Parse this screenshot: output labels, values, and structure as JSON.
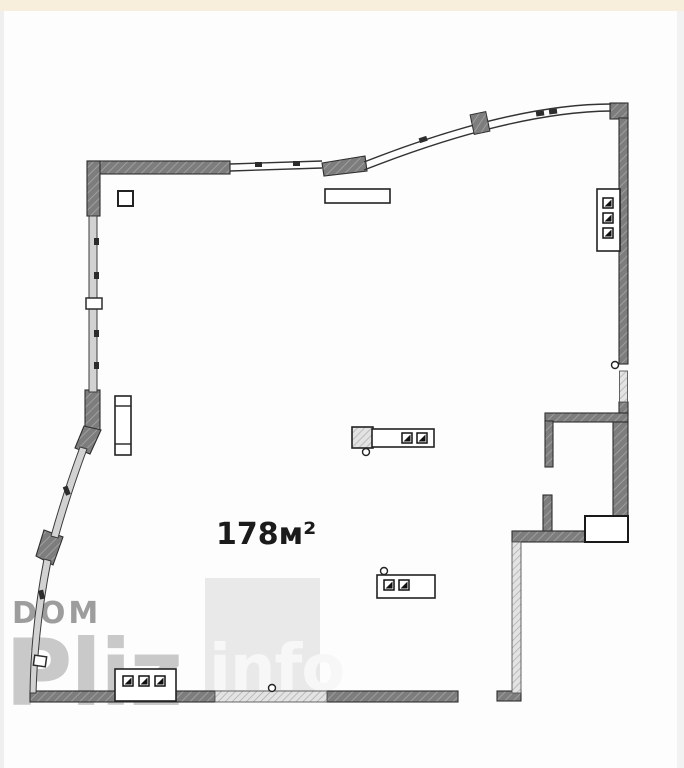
{
  "page": {
    "top_strip_color": "#f8eedc",
    "background_color": "#fdfdfd",
    "edge_border_color": "#efefef"
  },
  "plan": {
    "area_label": "178м²",
    "wall_color": "#7d7d7d",
    "light_wall_color": "#d8d8d8",
    "window_band_color": "#d2d2d2",
    "line_color": "#2e2e2e",
    "icons": {
      "electrical_panel_right": "panel-with-3-switch-squares",
      "electrical_panel_bottom": "panel-with-3-switch-squares",
      "island_unit_center": "hatched-block-with-2-switch-squares",
      "socket_box_lower": "box-with-2-switch-squares",
      "column_left": "tall-rect-with-dividers",
      "door_hinge_circles": "small-circle-markers"
    }
  },
  "watermark": {
    "word1": "DOM",
    "word2": "Pliz",
    "word3": "info",
    "word1_color": "#9d9d9d",
    "word2_color": "#c9c9c9",
    "word3_color": "#f7f7f7",
    "block_color": "#e9e9e9"
  }
}
